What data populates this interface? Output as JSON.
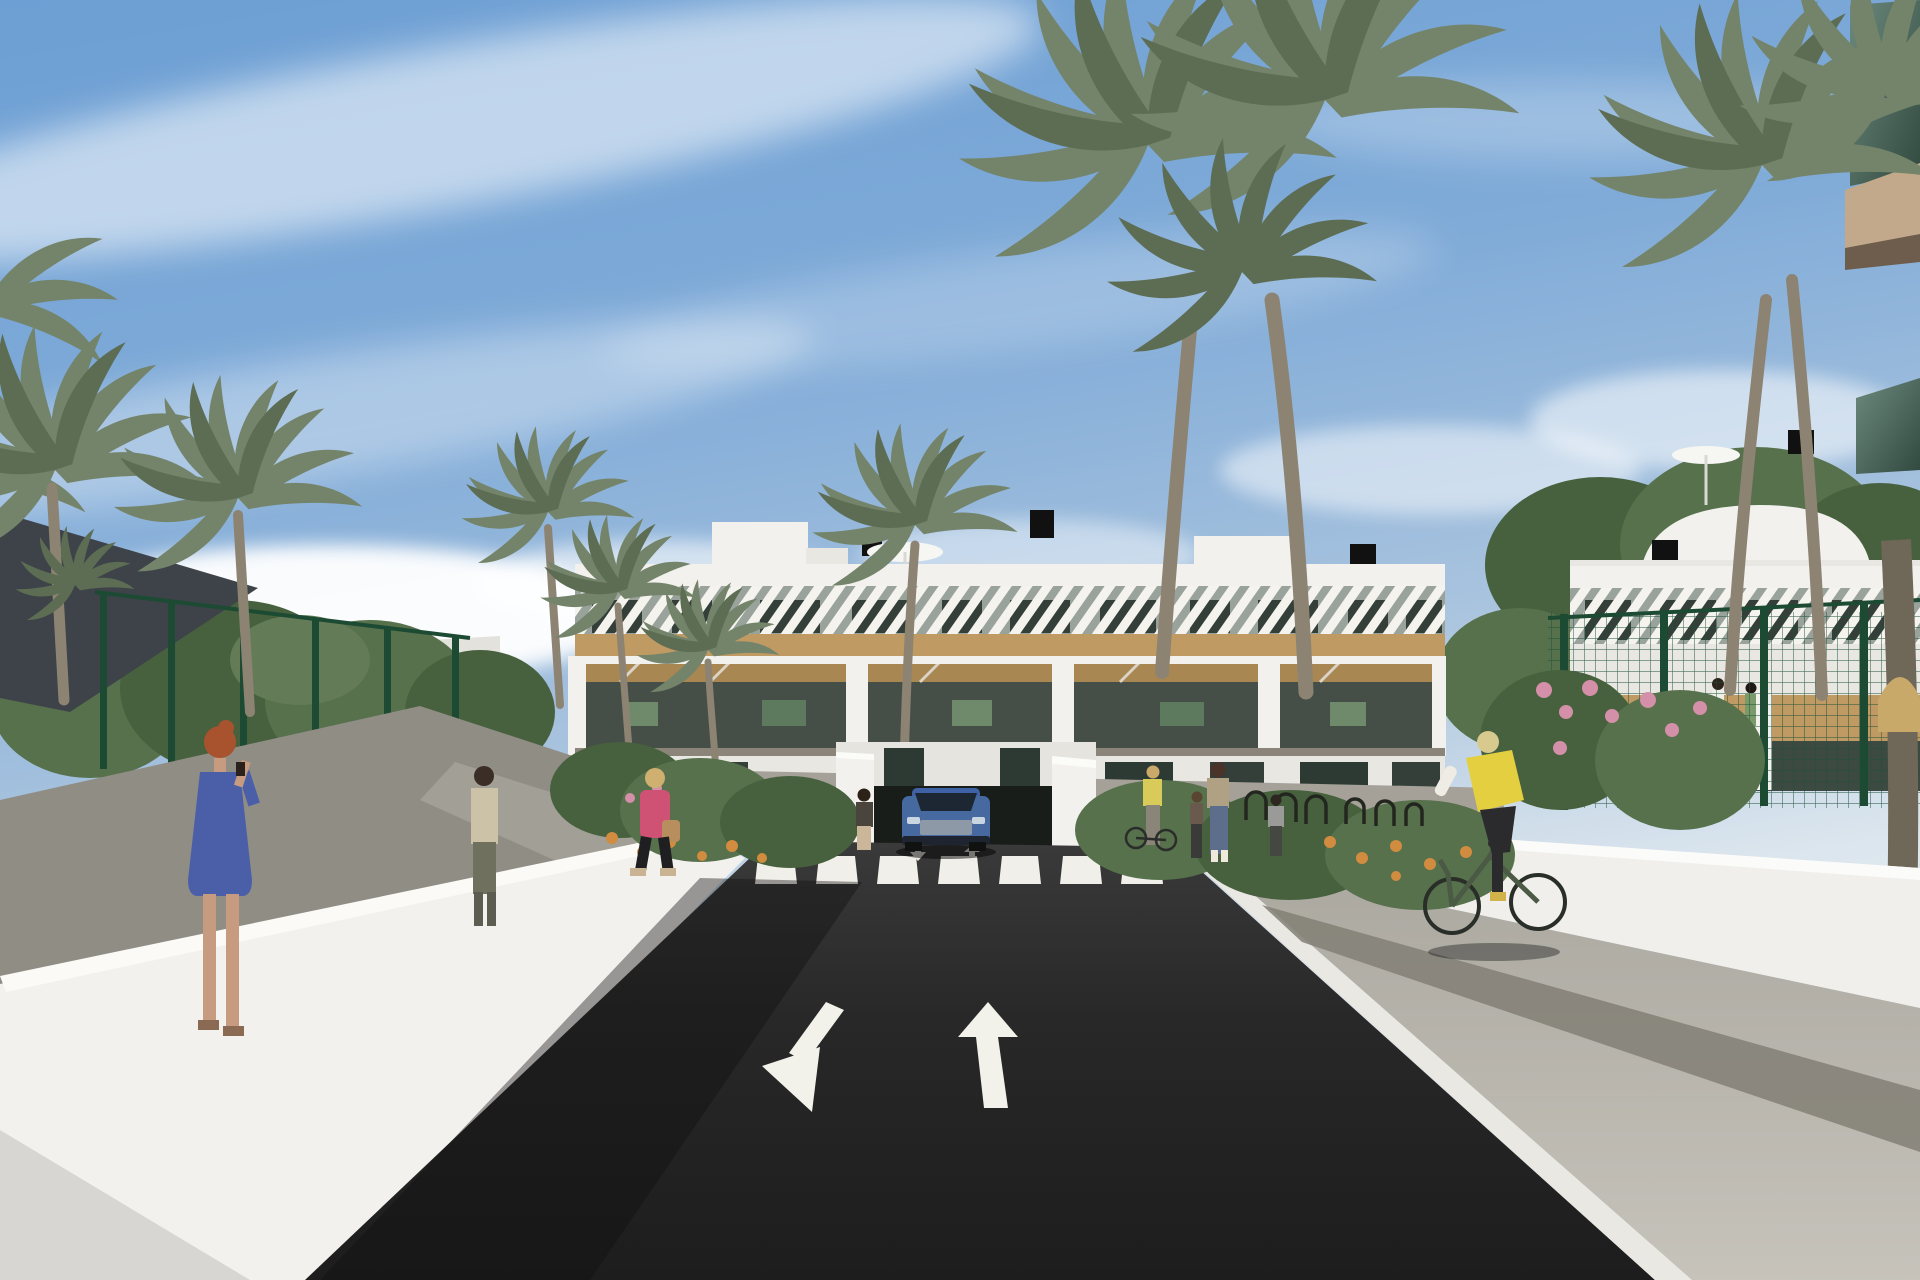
{
  "image": {
    "kind": "3d-architectural-render",
    "setting": "Sunny street view of a white Mediterranean apartment complex with palm trees, a two-way asphalt road, zebra crosswalk and an underground parking ramp",
    "no_visible_text": true
  },
  "palette": {
    "sky_top": "#6d9fd4",
    "sky_horizon": "#dce6ee",
    "cloud": "#ffffff",
    "asphalt": "#262626",
    "road_marking": "#f2f1ea",
    "white_wall": "#f2f1ed",
    "wall_shade": "#d8d7d2",
    "wood_band": "#c09a63",
    "slat_screen": "#9aa29c",
    "dark_window": "#343f39",
    "tree_green": "#56714c",
    "palm_green": "#74846a",
    "palm_trunk": "#8d8373",
    "fence_green": "#225239",
    "shade_sail": "#3d4348",
    "pavement": "#b6b3ab",
    "cobble_strip": "#837f76",
    "flower_orange": "#d28c3f",
    "flower_pink": "#d390a8",
    "glass_balcony": "#4f6e63",
    "fascia_beige": "#c3a98c"
  },
  "road": {
    "lanes": 2,
    "crosswalk_stripes": 7,
    "markings": [
      "down-left lane arrow",
      "straight-up lane arrow",
      "zebra crosswalk",
      "two small ramp arrows"
    ]
  },
  "vehicles": [
    {
      "type": "suv",
      "color": "#46699f",
      "position": "at underground parking ramp behind crosswalk"
    }
  ],
  "buildings": {
    "center": {
      "floors": 3,
      "style": "white modern block, rooftop terrace with parasol and chimneys, diagonal white slat screens on top floor, wooden fascia band, balconies with wooden pergolas"
    },
    "right": {
      "floors": 3,
      "style": "matching white block behind green mesh garden fence"
    },
    "foreground_right": {
      "feature": "tinted glass balconies of a building very close to camera"
    }
  },
  "people": [
    {
      "id": "woman-blue-dress",
      "desc": "red-haired woman in blue patterned dress talking on a phone",
      "colors": {
        "dress": "#4a5fa8",
        "hair": "#a8532e"
      }
    },
    {
      "id": "man-beige-shirt",
      "desc": "man standing near the green fence",
      "colors": {
        "shirt": "#ccc2a8",
        "trousers": "#70705f"
      }
    },
    {
      "id": "woman-pink-jacket",
      "desc": "blonde woman walking on the left sidewalk with a tan handbag",
      "colors": {
        "jacket": "#cf5274",
        "bag": "#b98e5e"
      }
    },
    {
      "id": "woman-at-ramp",
      "desc": "woman standing beside the parking ramp",
      "colors": {
        "top": "#4a443c",
        "trousers": "#cbb69a"
      }
    },
    {
      "id": "person-pushing-bike",
      "desc": "person in yellow jacket pushing a bicycle",
      "colors": {
        "top": "#d9cb5a"
      }
    },
    {
      "id": "mother-and-child",
      "desc": "woman in floral top and jeans with a small child",
      "colors": {
        "top": "#b0a184",
        "jeans": "#5d6d8c"
      }
    },
    {
      "id": "person-at-bike-racks",
      "desc": "person standing by the bike racks",
      "colors": {
        "top": "#9a9a98"
      }
    },
    {
      "id": "cyclist",
      "desc": "blonde cyclist in yellow vest and white sleeves on a green city bike",
      "colors": {
        "vest": "#e3cf3f",
        "bike": "#4a5a44"
      }
    },
    {
      "id": "balcony-residents",
      "desc": "two small figures on the right building balcony"
    }
  ],
  "vegetation": {
    "palms": "tall date palms lining the street and towering over the buildings",
    "shrubs": "flowering beds with orange and pink blooms",
    "fences": "green mesh garden fencing"
  },
  "street_furniture": [
    "bike racks",
    "wicker chair",
    "rooftop parasols",
    "dark shade sail"
  ]
}
